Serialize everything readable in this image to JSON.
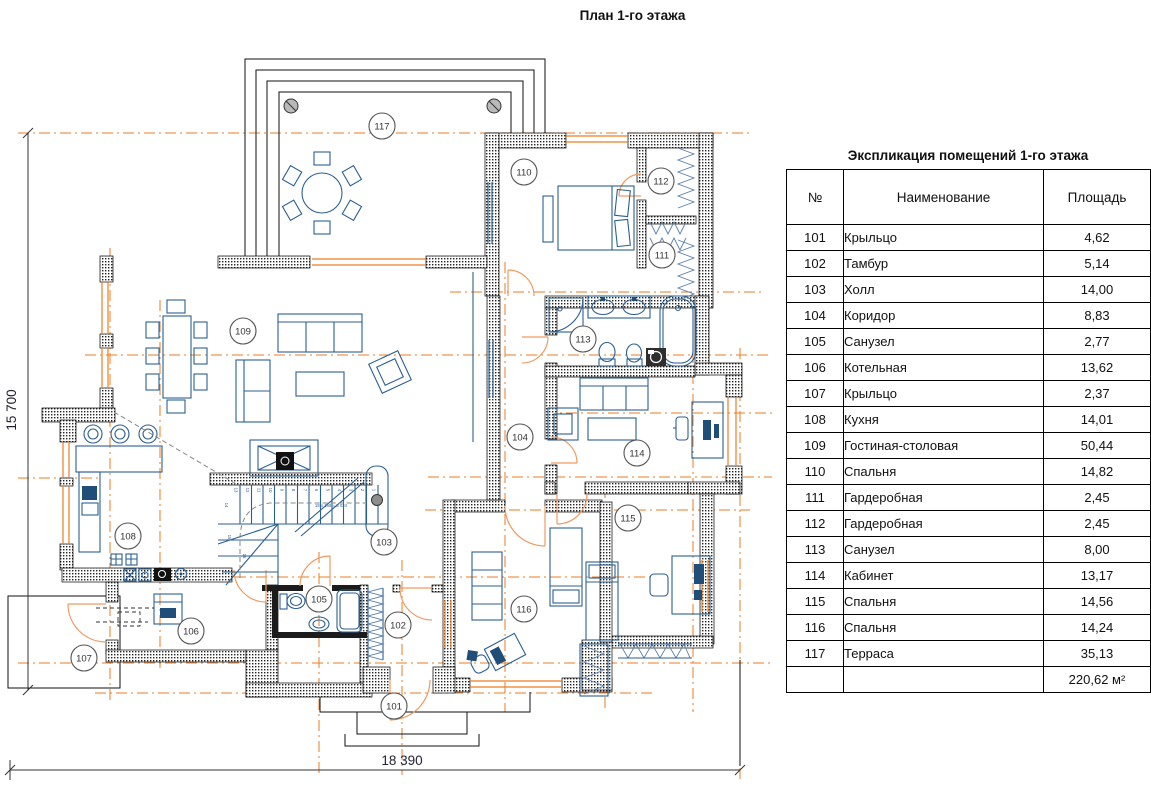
{
  "title": "План 1-го этажа",
  "schedule": {
    "title": "Экспликация помещений 1-го этажа",
    "columns": [
      "№",
      "Наименование",
      "Площадь"
    ],
    "rows": [
      {
        "num": "101",
        "name": "Крыльцо",
        "area": "4,62"
      },
      {
        "num": "102",
        "name": "Тамбур",
        "area": "5,14"
      },
      {
        "num": "103",
        "name": "Холл",
        "area": "14,00"
      },
      {
        "num": "104",
        "name": "Коридор",
        "area": "8,83"
      },
      {
        "num": "105",
        "name": "Санузел",
        "area": "2,77"
      },
      {
        "num": "106",
        "name": "Котельная",
        "area": "13,62"
      },
      {
        "num": "107",
        "name": "Крыльцо",
        "area": "2,37"
      },
      {
        "num": "108",
        "name": "Кухня",
        "area": "14,01"
      },
      {
        "num": "109",
        "name": "Гостиная-столовая",
        "area": "50,44"
      },
      {
        "num": "110",
        "name": "Спальня",
        "area": "14,82"
      },
      {
        "num": "111",
        "name": "Гардеробная",
        "area": "2,45"
      },
      {
        "num": "112",
        "name": "Гардеробная",
        "area": "2,45"
      },
      {
        "num": "113",
        "name": "Санузел",
        "area": "8,00"
      },
      {
        "num": "114",
        "name": "Кабинет",
        "area": "13,17"
      },
      {
        "num": "115",
        "name": "Спальня",
        "area": "14,56"
      },
      {
        "num": "116",
        "name": "Спальня",
        "area": "14,24"
      },
      {
        "num": "117",
        "name": "Терраса",
        "area": "35,13"
      }
    ],
    "total": "220,62 м²"
  },
  "dimensions": {
    "left": "15 700",
    "bottom": "18 390"
  },
  "stairs": {
    "note": "18 x 168 = 3 024",
    "flight_numbers": [
      "1",
      "2",
      "3",
      "4",
      "5",
      "6",
      "7",
      "8",
      "9",
      "10",
      "11",
      "12",
      "13"
    ],
    "winder_numbers": [
      "14",
      "15",
      "16"
    ]
  },
  "rooms": [
    {
      "num": "101",
      "x": 394,
      "y": 706
    },
    {
      "num": "102",
      "x": 398,
      "y": 625
    },
    {
      "num": "103",
      "x": 384,
      "y": 542
    },
    {
      "num": "104",
      "x": 520,
      "y": 437
    },
    {
      "num": "105",
      "x": 319,
      "y": 599
    },
    {
      "num": "106",
      "x": 191,
      "y": 631
    },
    {
      "num": "107",
      "x": 84,
      "y": 658
    },
    {
      "num": "108",
      "x": 128,
      "y": 536
    },
    {
      "num": "109",
      "x": 243,
      "y": 331
    },
    {
      "num": "110",
      "x": 524,
      "y": 172
    },
    {
      "num": "111",
      "x": 662,
      "y": 255
    },
    {
      "num": "112",
      "x": 661,
      "y": 181
    },
    {
      "num": "113",
      "x": 583,
      "y": 339
    },
    {
      "num": "114",
      "x": 637,
      "y": 453
    },
    {
      "num": "115",
      "x": 628,
      "y": 518
    },
    {
      "num": "116",
      "x": 524,
      "y": 609
    },
    {
      "num": "117",
      "x": 382,
      "y": 126
    }
  ]
}
